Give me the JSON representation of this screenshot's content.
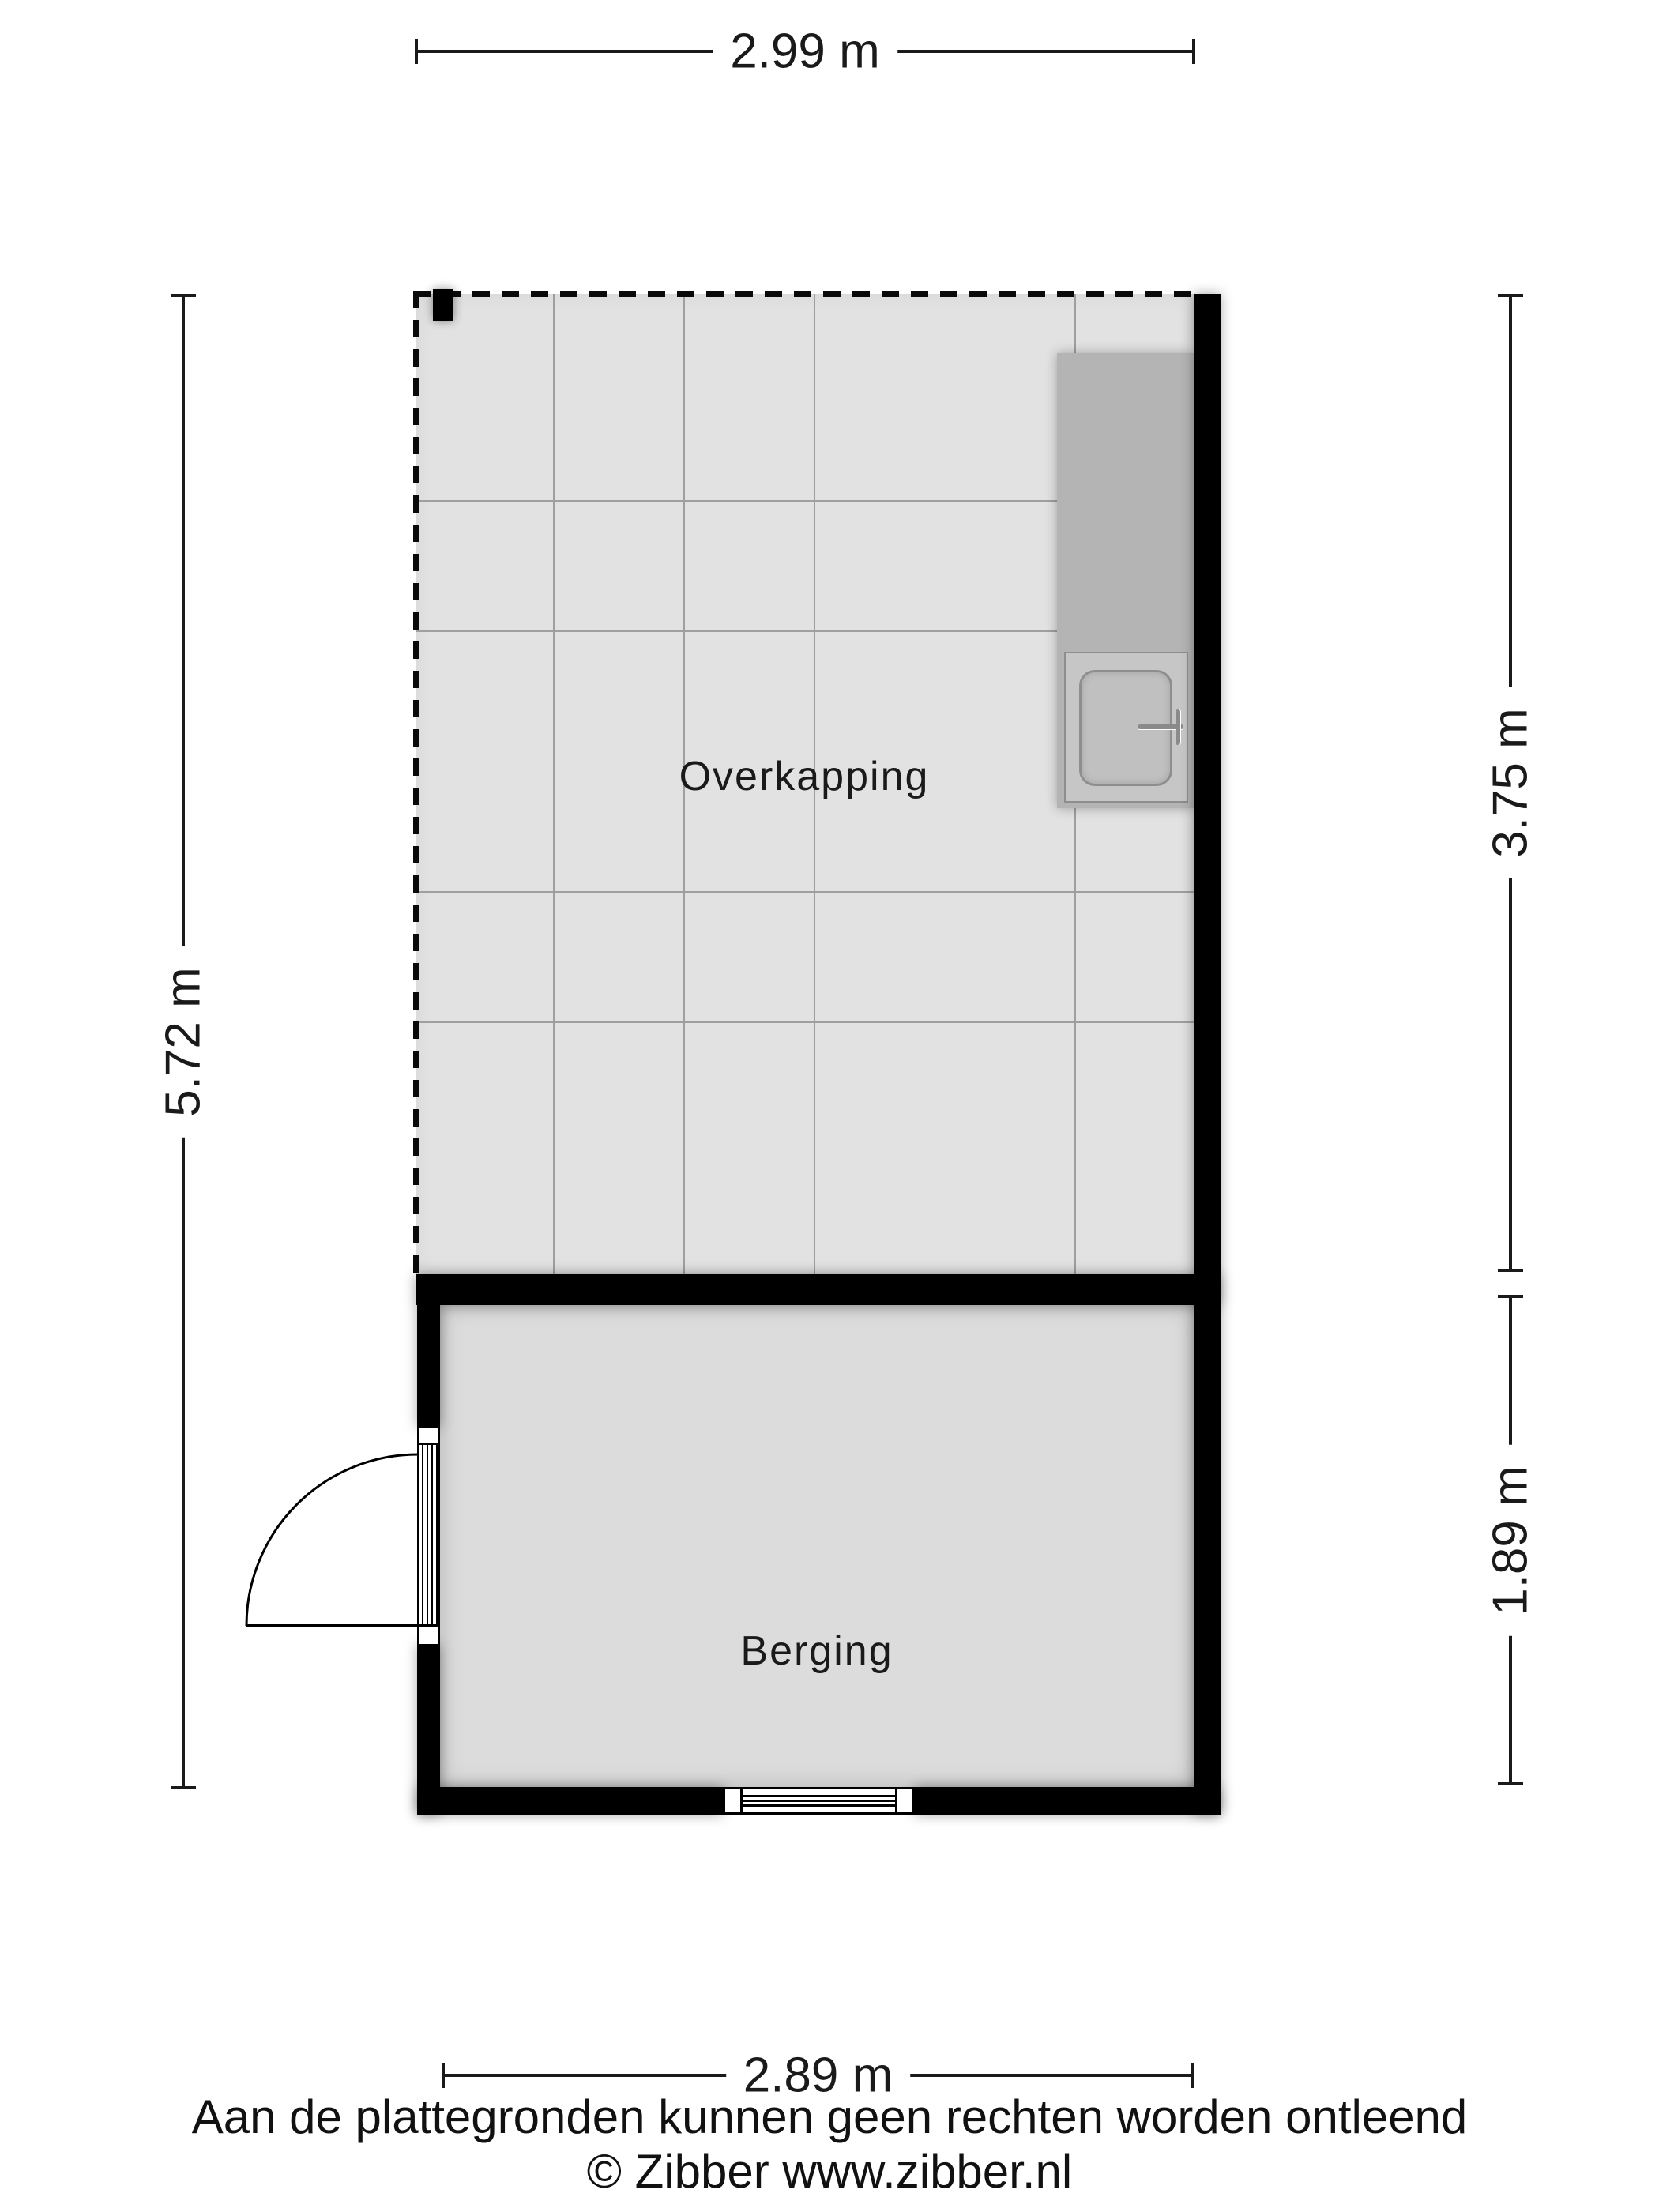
{
  "colors": {
    "wall": "#000000",
    "overkapping_floor": "#e2e2e2",
    "berging_floor": "#dcdcdc",
    "tile_line": "#9f9f9f",
    "counter": "#b4b4b4",
    "sink_unit": "#c6c6c6",
    "sink_basin": "#c0c0c0",
    "sink_outline": "#8e8e8e",
    "dim_line": "#1a1a1a",
    "text": "#1a1a1a"
  },
  "rooms": {
    "overkapping": {
      "label": "Overkapping"
    },
    "berging": {
      "label": "Berging"
    }
  },
  "dimensions": {
    "top": "2.99 m",
    "left": "5.72 m",
    "right_upper": "3.75 m",
    "right_lower": "1.89 m",
    "bottom": "2.89 m"
  },
  "footer": {
    "disclaimer": "Aan de plattegronden kunnen geen rechten worden ontleend",
    "copyright": "© Zibber www.zibber.nl"
  }
}
